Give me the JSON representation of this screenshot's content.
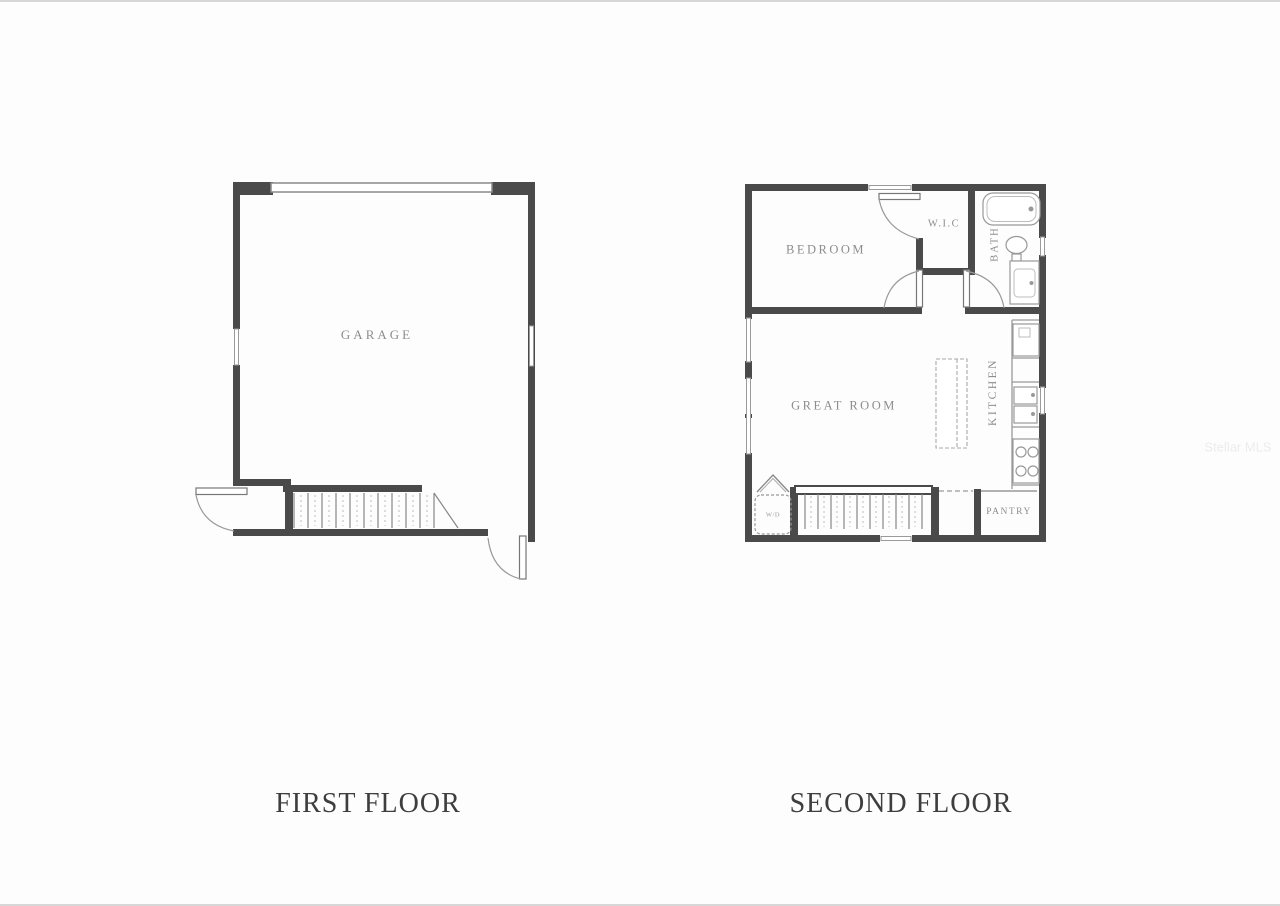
{
  "colors": {
    "wall": "#4a4a4a",
    "fixture": "#999999",
    "room_label": "#8d8d8d",
    "title": "#3e3e3e",
    "watermark": "#ececec"
  },
  "first_floor": {
    "title": "FIRST FLOOR",
    "garage_label": "GARAGE"
  },
  "second_floor": {
    "title": "SECOND FLOOR",
    "bedroom_label": "BEDROOM",
    "wic_label": "W.I.C",
    "bath_label": "BATH",
    "great_room_label": "GREAT ROOM",
    "kitchen_label": "KITCHEN",
    "pantry_label": "PANTRY",
    "washer_dryer_label": "W/D"
  },
  "watermark": "Stellar MLS"
}
